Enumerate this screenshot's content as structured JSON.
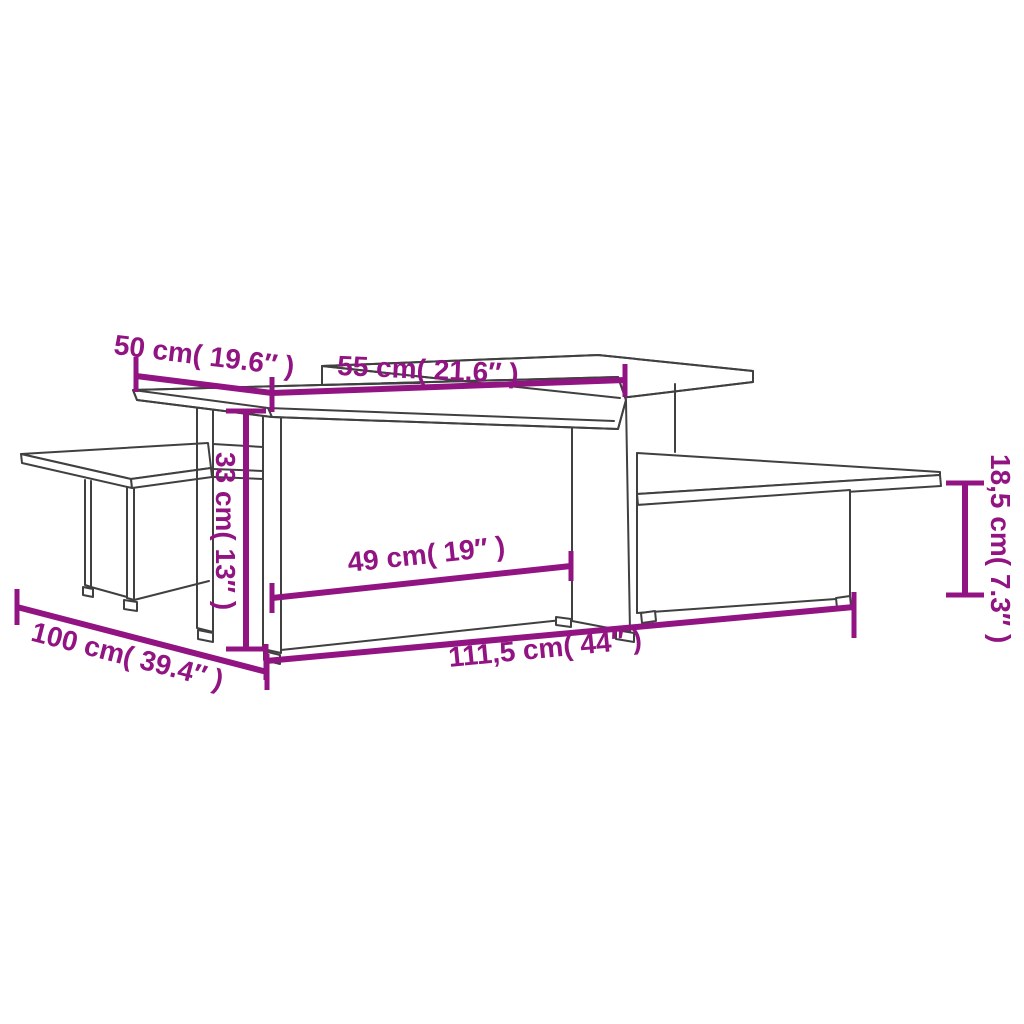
{
  "diagram": {
    "kind": "product-dimension-diagram",
    "subject": "two interlocking coffee tables line drawing",
    "dimensions": [
      {
        "id": "top-depth",
        "label": "50 cm( 19.6″ )"
      },
      {
        "id": "top-length",
        "label": "55 cm( 21.6″ )"
      },
      {
        "id": "height-tall",
        "label": "33 cm( 13″ )"
      },
      {
        "id": "opening-width",
        "label": "49 cm( 19″ )"
      },
      {
        "id": "total-length",
        "label": "111,5 cm( 44″ )"
      },
      {
        "id": "table-depth",
        "label": "100 cm( 39.4″ )"
      },
      {
        "id": "height-low",
        "label": "18,5 cm( 7.3″ )"
      }
    ],
    "colors": {
      "dimension": "#911482",
      "line": "#404040",
      "background": "#ffffff"
    }
  }
}
